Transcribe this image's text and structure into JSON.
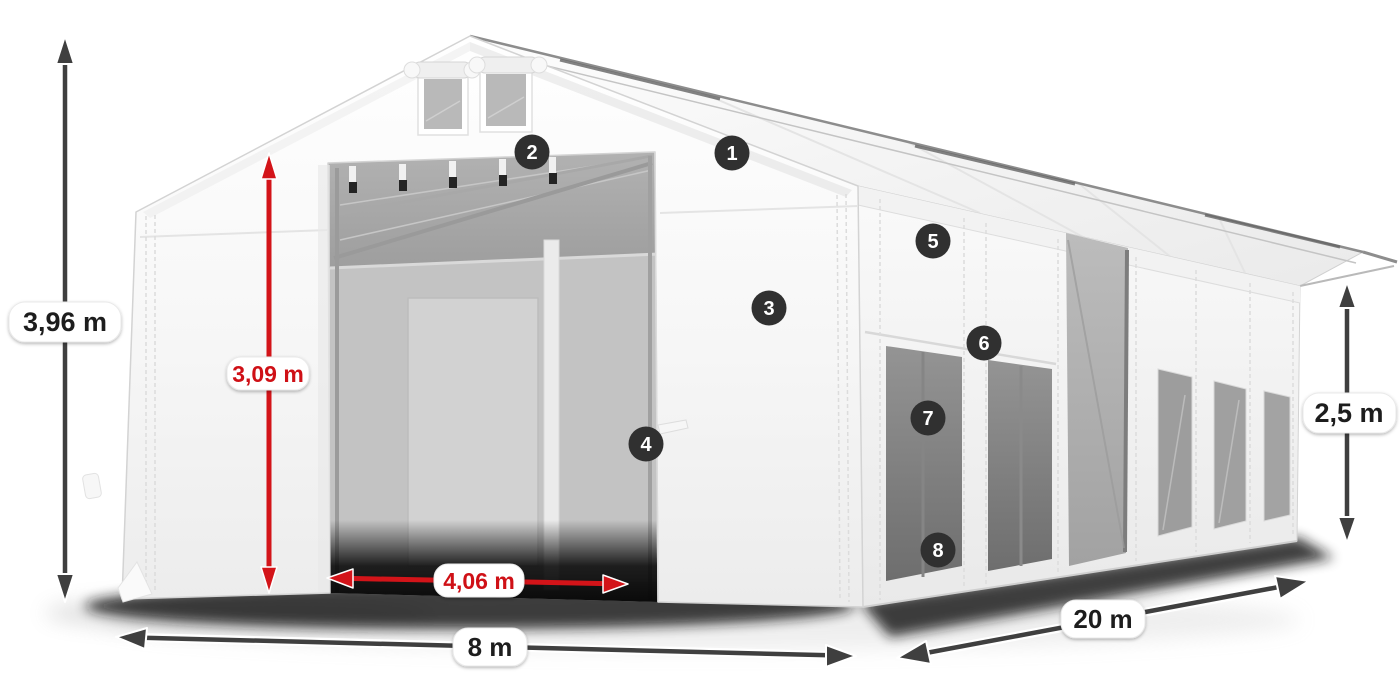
{
  "diagram": {
    "kind": "tent-dimension-diagram"
  },
  "dimensions": {
    "total_height": "3,96 m",
    "door_height": "3,09 m",
    "door_width": "4,06 m",
    "front_width": "8 m",
    "length": "20 m",
    "side_height": "2,5 m"
  },
  "callouts": [
    {
      "number": "1"
    },
    {
      "number": "2"
    },
    {
      "number": "3"
    },
    {
      "number": "4"
    },
    {
      "number": "5"
    },
    {
      "number": "6"
    },
    {
      "number": "7"
    },
    {
      "number": "8"
    }
  ],
  "colors": {
    "red": "#d31419",
    "red_text": "#cf1016",
    "arrow": "#3f3f3f",
    "badge": "#303030",
    "label_background": "#ffffff",
    "fabric_white": "#f9f9f9",
    "interior_gray": "#b9b9b9",
    "window_gray": "#9d9d9d"
  }
}
